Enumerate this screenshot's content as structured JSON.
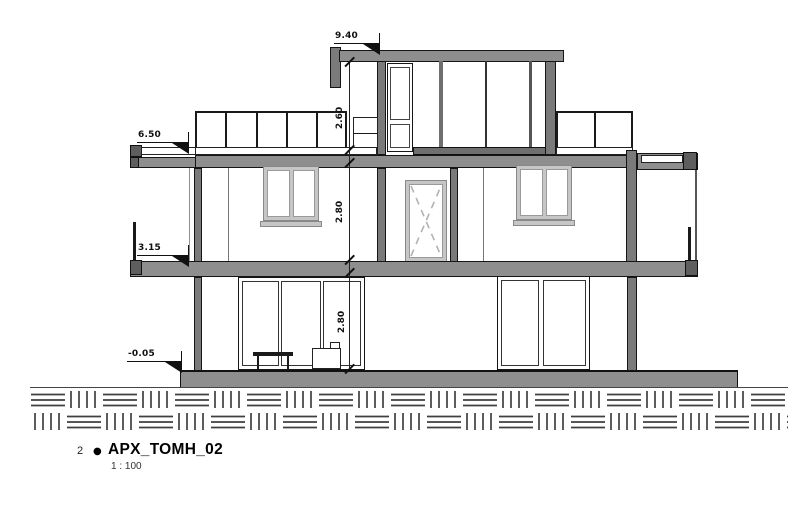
{
  "drawing": {
    "item_number": "2",
    "bullet": "●",
    "title": "APX_TOMH_02",
    "scale": "1 : 100"
  },
  "elevation_markers": [
    {
      "name": "roof-level",
      "value": "9.40"
    },
    {
      "name": "terrace-level",
      "value": "6.50"
    },
    {
      "name": "first-floor-level",
      "value": "3.15"
    },
    {
      "name": "ground-level",
      "value": "-0.05"
    }
  ],
  "dimensions": [
    {
      "name": "penthouse-clear-height",
      "value": "2.60"
    },
    {
      "name": "first-floor-clear-height",
      "value": "2.80"
    },
    {
      "name": "ground-floor-clear-height",
      "value": "2.80"
    }
  ],
  "colors": {
    "cut_slab_fill": "#8e8e8e",
    "cut_wall_fill": "#7a7a7a",
    "end_cap_fill": "#5e5e5e",
    "window_frame": "#c6c6c6",
    "line": "#111111",
    "background": "#ffffff"
  }
}
